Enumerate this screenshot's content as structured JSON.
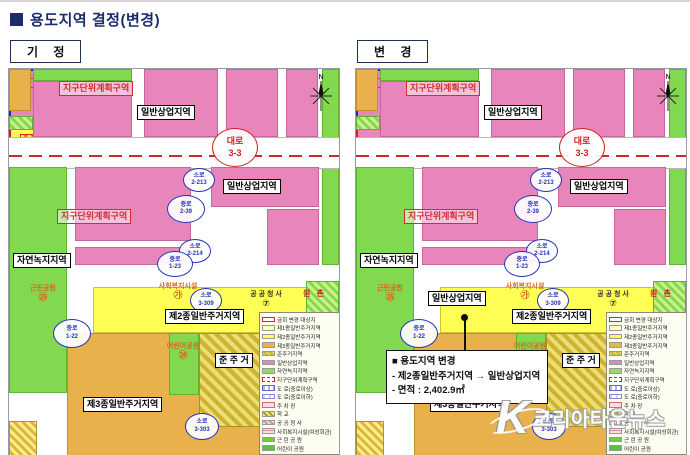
{
  "title": "용도지역 결정(변경)",
  "panel_left_tag": "기 정",
  "panel_right_tag": "변 경",
  "map": {
    "district_plan": "지구단위계획구역",
    "commercial": "일반상업지역",
    "natural_green": "자연녹지지역",
    "neighborhood_park": "근린공원",
    "neighborhood_park_no": "㉕",
    "res2": "제2종일반주거지역",
    "res3": "제3종일반주거지역",
    "semi_res": "준 주 거",
    "welfare": "사회복지시설",
    "welfare_no": "㉮",
    "public_office": "공 공 청 사",
    "public_office_no": "⑦",
    "children_park": "어린이공원",
    "children_park_no": "㉔",
    "parking": "주 차 장",
    "parking_no5": "⑤",
    "parking_no8": "⑧",
    "woncheon": "원 촌",
    "north": "N",
    "roads": {
      "daero": "대로",
      "daero_no": "3-3",
      "soro": "소로",
      "jungro": "중로",
      "s2213": "2-213",
      "j239": "2-39",
      "s2214": "2-214",
      "j123": "1-23",
      "j122": "1-22",
      "s3309": "3-309",
      "s3303": "3-303"
    }
  },
  "changed_parcel_label": "일반상업지역",
  "callout": {
    "title": "■ 용도지역 변경",
    "line1": "- 제2종일반주거지역 → 일반상업지역",
    "line2": "- 면적 : 2,402.9㎡"
  },
  "legend": {
    "items": [
      {
        "label": "금회 변경 대상지",
        "swatch": "sw-change"
      },
      {
        "label": "제1종일반주거지역",
        "swatch": "sw-r1"
      },
      {
        "label": "제2종일반주거지역",
        "swatch": "sw-r2"
      },
      {
        "label": "제3종일반주거지역",
        "swatch": "sw-r3"
      },
      {
        "label": "준주거지역",
        "swatch": "sw-semi"
      },
      {
        "label": "일반상업지역",
        "swatch": "sw-comm"
      },
      {
        "label": "자연녹지지역",
        "swatch": "sw-green"
      },
      {
        "label": "지구단위계획구역",
        "swatch": "sw-district"
      },
      {
        "label": "도 로(중로이상)",
        "swatch": "sw-road1"
      },
      {
        "label": "도 로(중로이하)",
        "swatch": "sw-road2"
      },
      {
        "label": "주 차 장",
        "swatch": "sw-parking"
      },
      {
        "label": "학 교",
        "swatch": "sw-school"
      },
      {
        "label": "공 공 청 사",
        "swatch": "sw-office"
      },
      {
        "label": "사회복지시설(여성회관)",
        "swatch": "sw-welfare"
      },
      {
        "label": "근 린 공 원",
        "swatch": "sw-park"
      },
      {
        "label": "어린이 공원",
        "swatch": "sw-childpark"
      }
    ]
  },
  "watermark": {
    "logo": "K",
    "text": "코리아타운뉴스"
  },
  "colors": {
    "accent_navy": "#1c2b6e",
    "zone_pink": "#e886bb",
    "zone_yellow": "#ffff55",
    "zone_orange": "#e9b14b",
    "zone_green": "#82d94f",
    "highlight_red": "#cc1f1f",
    "road_blue": "#2333bb"
  }
}
